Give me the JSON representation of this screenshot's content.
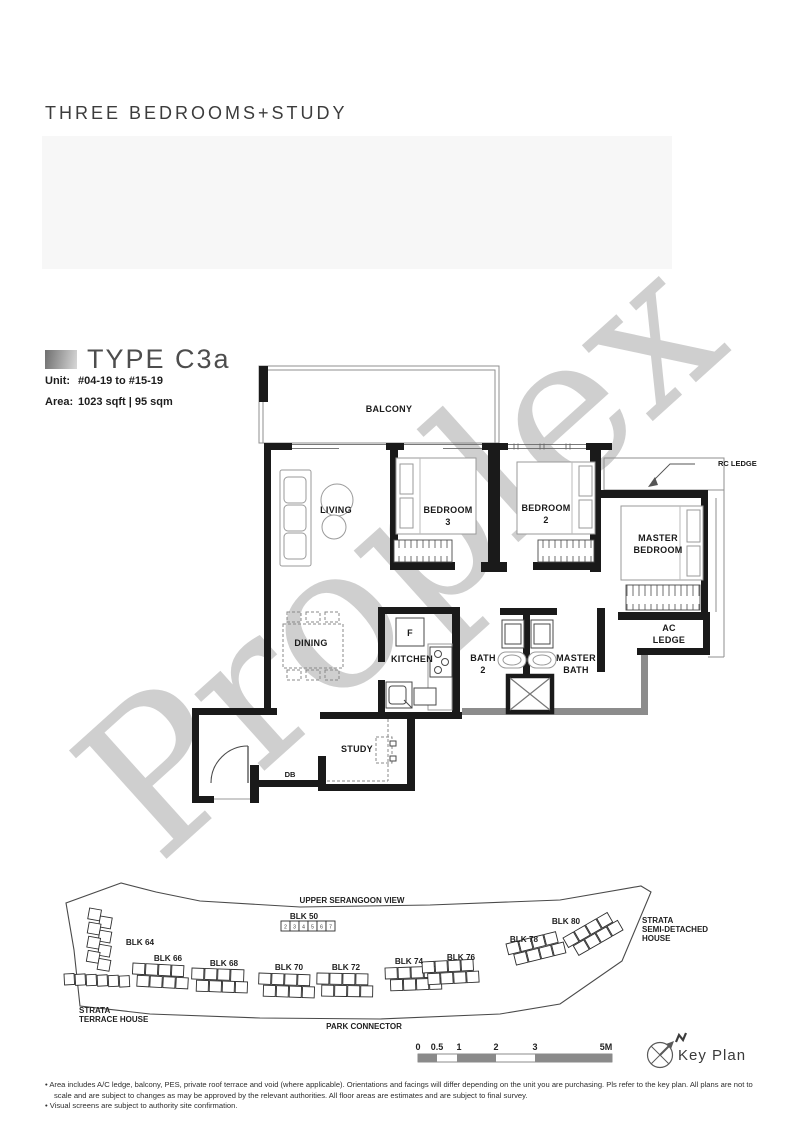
{
  "page": {
    "title": "THREE BEDROOMS+STUDY",
    "watermark": "Proplex"
  },
  "unit_info": {
    "type_title": "TYPE C3a",
    "unit_label": "Unit:",
    "unit_value": "#04-19 to #15-19",
    "area_label": "Area:",
    "area_value": "1023 sqft | 95 sqm"
  },
  "floor_plan": {
    "balcony": "BALCONY",
    "living": "LIVING",
    "dining": "DINING",
    "kitchen": "KITCHEN",
    "fridge": "F",
    "study": "STUDY",
    "db": "DB",
    "rc_ledge": "RC LEDGE",
    "bedroom3": [
      "BEDROOM",
      "3"
    ],
    "bedroom2": [
      "BEDROOM",
      "2"
    ],
    "master_bedroom": [
      "MASTER",
      "BEDROOM"
    ],
    "bath2": [
      "BATH",
      "2"
    ],
    "master_bath": [
      "MASTER",
      "BATH"
    ],
    "ac_ledge": [
      "AC",
      "LEDGE"
    ]
  },
  "key_plan": {
    "road_top": "UPPER SERANGOON VIEW",
    "road_bottom": "PARK CONNECTOR",
    "blocks": [
      "BLK 50",
      "BLK 64",
      "BLK 66",
      "BLK 68",
      "BLK 70",
      "BLK 72",
      "BLK 74",
      "BLK 76",
      "BLK 78",
      "BLK 80"
    ],
    "blk50_units": [
      "2",
      "3",
      "4",
      "5",
      "6",
      "7"
    ],
    "strata_terrace": [
      "STRATA",
      "TERRACE HOUSE"
    ],
    "strata_semi": [
      "STRATA",
      "SEMI-DETACHED",
      "HOUSE"
    ],
    "highlight_color": "#9c9c9c",
    "key_plan_label": "Key Plan"
  },
  "scale_bar": {
    "labels": [
      "0",
      "0.5",
      "1",
      "2",
      "3",
      "5M"
    ]
  },
  "footnotes": [
    "•  Area includes A/C ledge, balcony, PES, private roof terrace and void (where applicable). Orientations and facings will differ depending on the unit you are purchasing. Pls refer to the key plan. All plans are not to scale and are subject to changes as may be approved by the relevant authorities. All floor areas are estimates and are subject to final survey.",
    "•  Visual screens are subject to authority site confirmation."
  ]
}
